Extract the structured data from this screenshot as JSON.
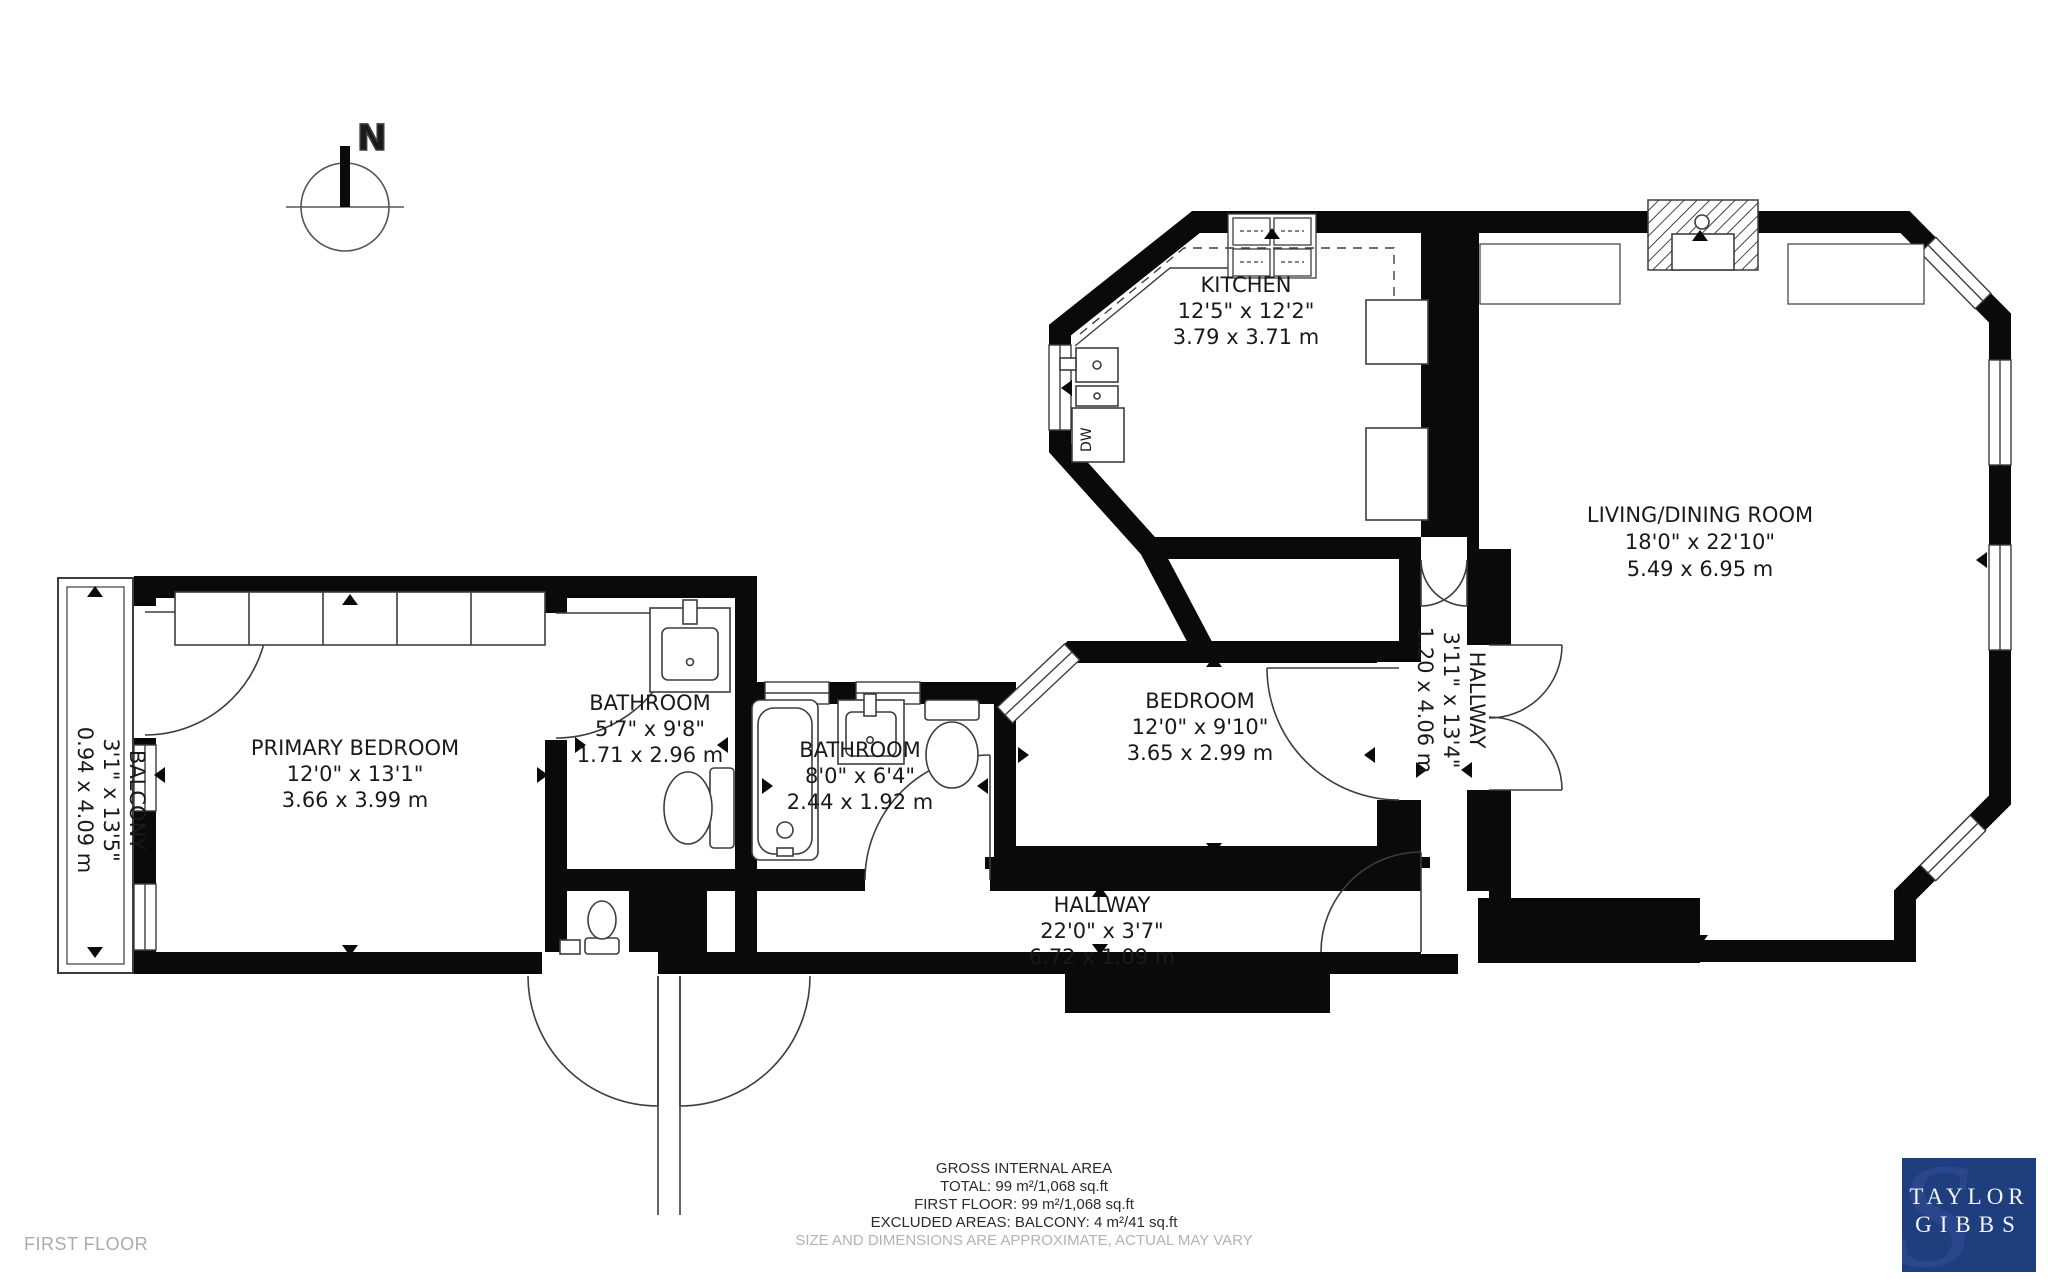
{
  "floor_label": "FIRST FLOOR",
  "compass": {
    "north_label": "N"
  },
  "rooms": [
    {
      "id": "kitchen",
      "name": "KITCHEN",
      "imperial": "12'5\" x 12'2\"",
      "metric": "3.79 x 3.71 m"
    },
    {
      "id": "living",
      "name": "LIVING/DINING ROOM",
      "imperial": "18'0\" x 22'10\"",
      "metric": "5.49 x 6.95 m"
    },
    {
      "id": "bedroom",
      "name": "BEDROOM",
      "imperial": "12'0\" x 9'10\"",
      "metric": "3.65 x 2.99 m"
    },
    {
      "id": "primary",
      "name": "PRIMARY BEDROOM",
      "imperial": "12'0\" x 13'1\"",
      "metric": "3.66 x 3.99 m"
    },
    {
      "id": "bath1",
      "name": "BATHROOM",
      "imperial": "5'7\" x 9'8\"",
      "metric": "1.71 x 2.96 m"
    },
    {
      "id": "bath2",
      "name": "BATHROOM",
      "imperial": "8'0\" x 6'4\"",
      "metric": "2.44 x 1.92 m"
    },
    {
      "id": "hallway",
      "name": "HALLWAY",
      "imperial": "22'0\" x 3'7\"",
      "metric": "6.72 x 1.09 m"
    },
    {
      "id": "hallway2",
      "name": "HALLWAY",
      "imperial": "3'11\" x 13'4\"",
      "metric": "1.20 x 4.06 m"
    },
    {
      "id": "balcony",
      "name": "BALCONY",
      "imperial": "3'1\" x 13'5\"",
      "metric": "0.94 x 4.09 m"
    }
  ],
  "fixtures": {
    "dishwasher_label": "DW"
  },
  "footer": {
    "area_title": "GROSS INTERNAL AREA",
    "total": "TOTAL: 99 m²/1,068 sq.ft",
    "first_floor": "FIRST FLOOR: 99 m²/1,068 sq.ft",
    "excluded": "EXCLUDED AREAS: BALCONY: 4 m²/41 sq.ft",
    "disclaimer": "SIZE AND DIMENSIONS ARE APPROXIMATE, ACTUAL MAY VARY"
  },
  "logo": {
    "line1": "TAYLOR",
    "line2": "GIBBS",
    "bg": "#1f3e7d"
  }
}
